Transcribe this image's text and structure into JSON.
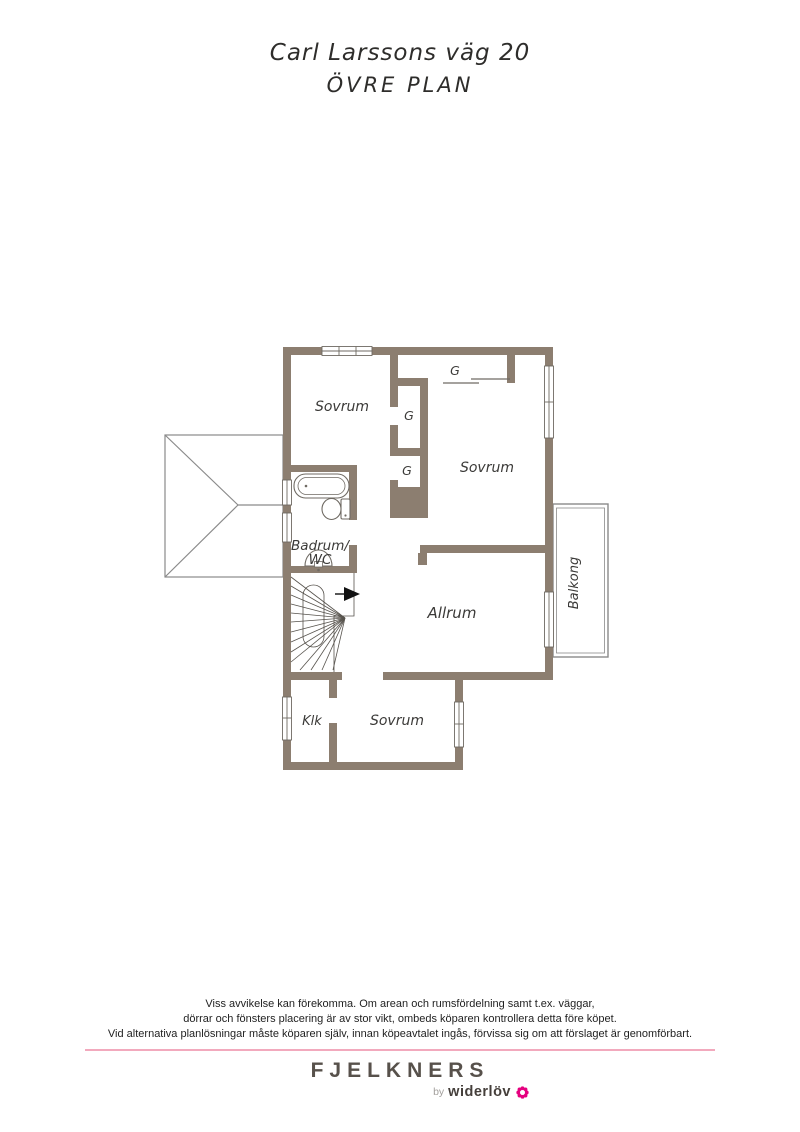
{
  "title": {
    "line1": "Carl Larssons väg 20",
    "line2": "ÖVRE PLAN"
  },
  "plan": {
    "rooms": {
      "sovrum_top_left": "Sovrum",
      "sovrum_top_right": "Sovrum",
      "allrum": "Allrum",
      "sovrum_bottom": "Sovrum",
      "klk": "Klk",
      "badrum_line1": "Badrum/",
      "badrum_line2": "WC",
      "balkong": "Balkong"
    },
    "g_labels": [
      "G",
      "G",
      "G"
    ],
    "colors": {
      "wall": "#8c7e70",
      "sketch_line": "#6f6a63",
      "arrow": "#111111"
    }
  },
  "disclaimer": {
    "line1": "Viss avvikelse kan förekomma. Om arean och rumsfördelning samt t.ex. väggar,",
    "line2": "dörrar och fönsters placering är av stor vikt, ombeds köparen kontrollera detta före köpet.",
    "line3": "Vid alternativa planlösningar måste köparen själv, innan köpeavtalet ingås, förvissa sig om att förslaget är genomförbart."
  },
  "footer": {
    "brand": "FJELKNERS",
    "byline_prefix": "by",
    "byline_brand": "widerlöv",
    "accent_pink": "#e5017f",
    "rule_pink": "#f2a9bd"
  }
}
